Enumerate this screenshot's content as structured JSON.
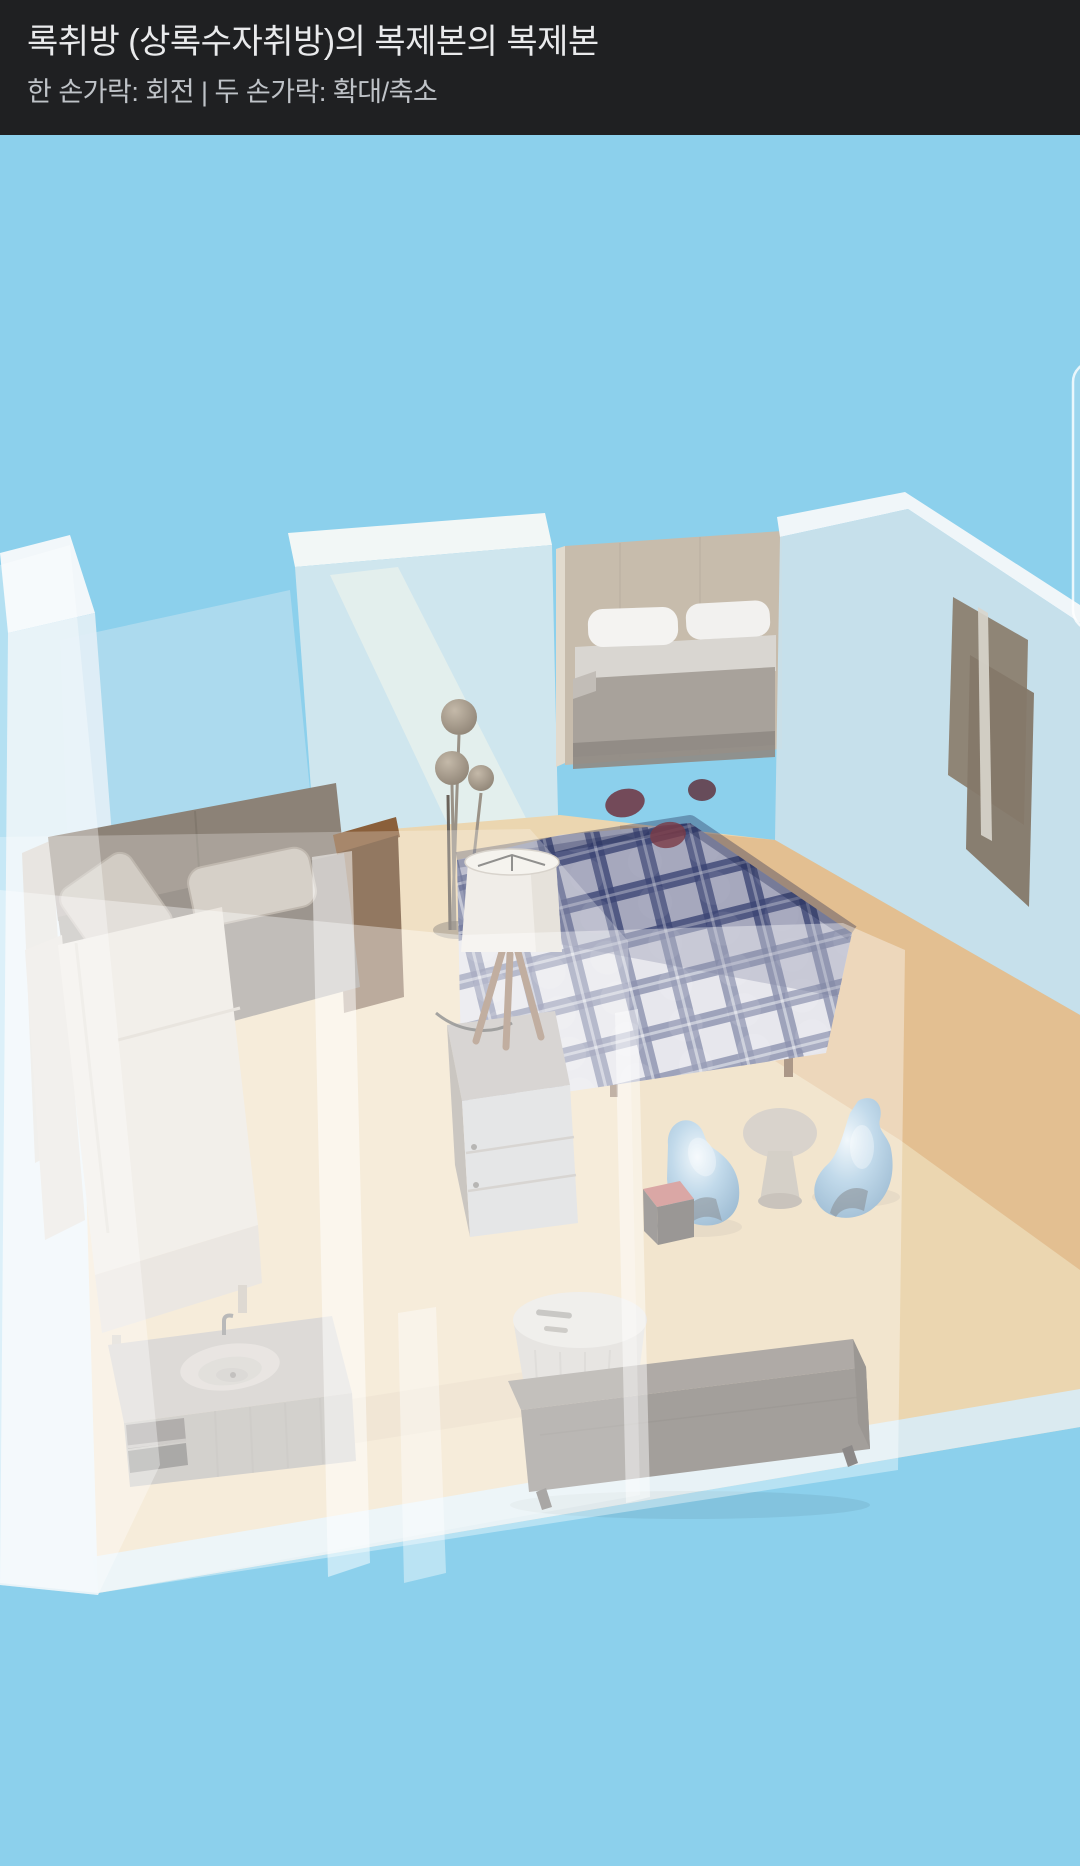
{
  "header": {
    "title": "록취방 (상록수자취방)의 복제본의 복제본",
    "subtitle": "한 손가락: 회전 | 두 손가락: 확대/축소",
    "background": "#1F2022",
    "title_color": "#E9EAEC",
    "subtitle_color": "#BFC3C8"
  },
  "viewport": {
    "mode": "3d-room-view",
    "gesture_hints": {
      "one_finger": "회전",
      "two_fingers": "확대/축소"
    },
    "side_panel_edge_visible": true
  },
  "scene": {
    "sky_color": "#8CD0EC",
    "floor_color": "#EBD6B0",
    "floor_accent_color": "#E2BD8E",
    "wall_glass_color": "#D3E7EE",
    "wall_cap_color": "#F2F7F9",
    "objects": [
      {
        "id": "sectional-sofa",
        "kind": "sofa",
        "primary_color": "#8C8277",
        "secondary_color": "#E4DDD3"
      },
      {
        "id": "wood-side-shelf",
        "kind": "shelf",
        "primary_color": "#6E4B2D"
      },
      {
        "id": "floor-lamp",
        "kind": "lamp",
        "primary_color": "#A79B8C"
      },
      {
        "id": "table-lamp",
        "kind": "lamp",
        "primary_color": "#EBE7E0"
      },
      {
        "id": "dresser",
        "kind": "storage",
        "primary_color": "#C8CACB"
      },
      {
        "id": "plaid-bed",
        "kind": "bed",
        "primary_color": "#46507E",
        "secondary_color": "#D8D8E2"
      },
      {
        "id": "alcove-bed",
        "kind": "bed",
        "primary_color": "#A8A29B",
        "headboard_color": "#C7BCAC"
      },
      {
        "id": "accent-chair-left",
        "kind": "chair",
        "primary_color": "#9CC3DE"
      },
      {
        "id": "accent-chair-right",
        "kind": "chair",
        "primary_color": "#9CC3DE"
      },
      {
        "id": "side-table",
        "kind": "table",
        "primary_color": "#BCB3A7"
      },
      {
        "id": "cube-stool",
        "kind": "stool",
        "primary_color": "#C4716E"
      },
      {
        "id": "vanity-unit",
        "kind": "vanity",
        "primary_color": "#A29C95"
      },
      {
        "id": "laundry-hamper",
        "kind": "hamper",
        "primary_color": "#DFDCD7"
      },
      {
        "id": "tv-sideboard",
        "kind": "sideboard",
        "primary_color": "#6B645E"
      },
      {
        "id": "wall-art",
        "kind": "frames",
        "primary_color": "#8C7F70"
      }
    ]
  }
}
